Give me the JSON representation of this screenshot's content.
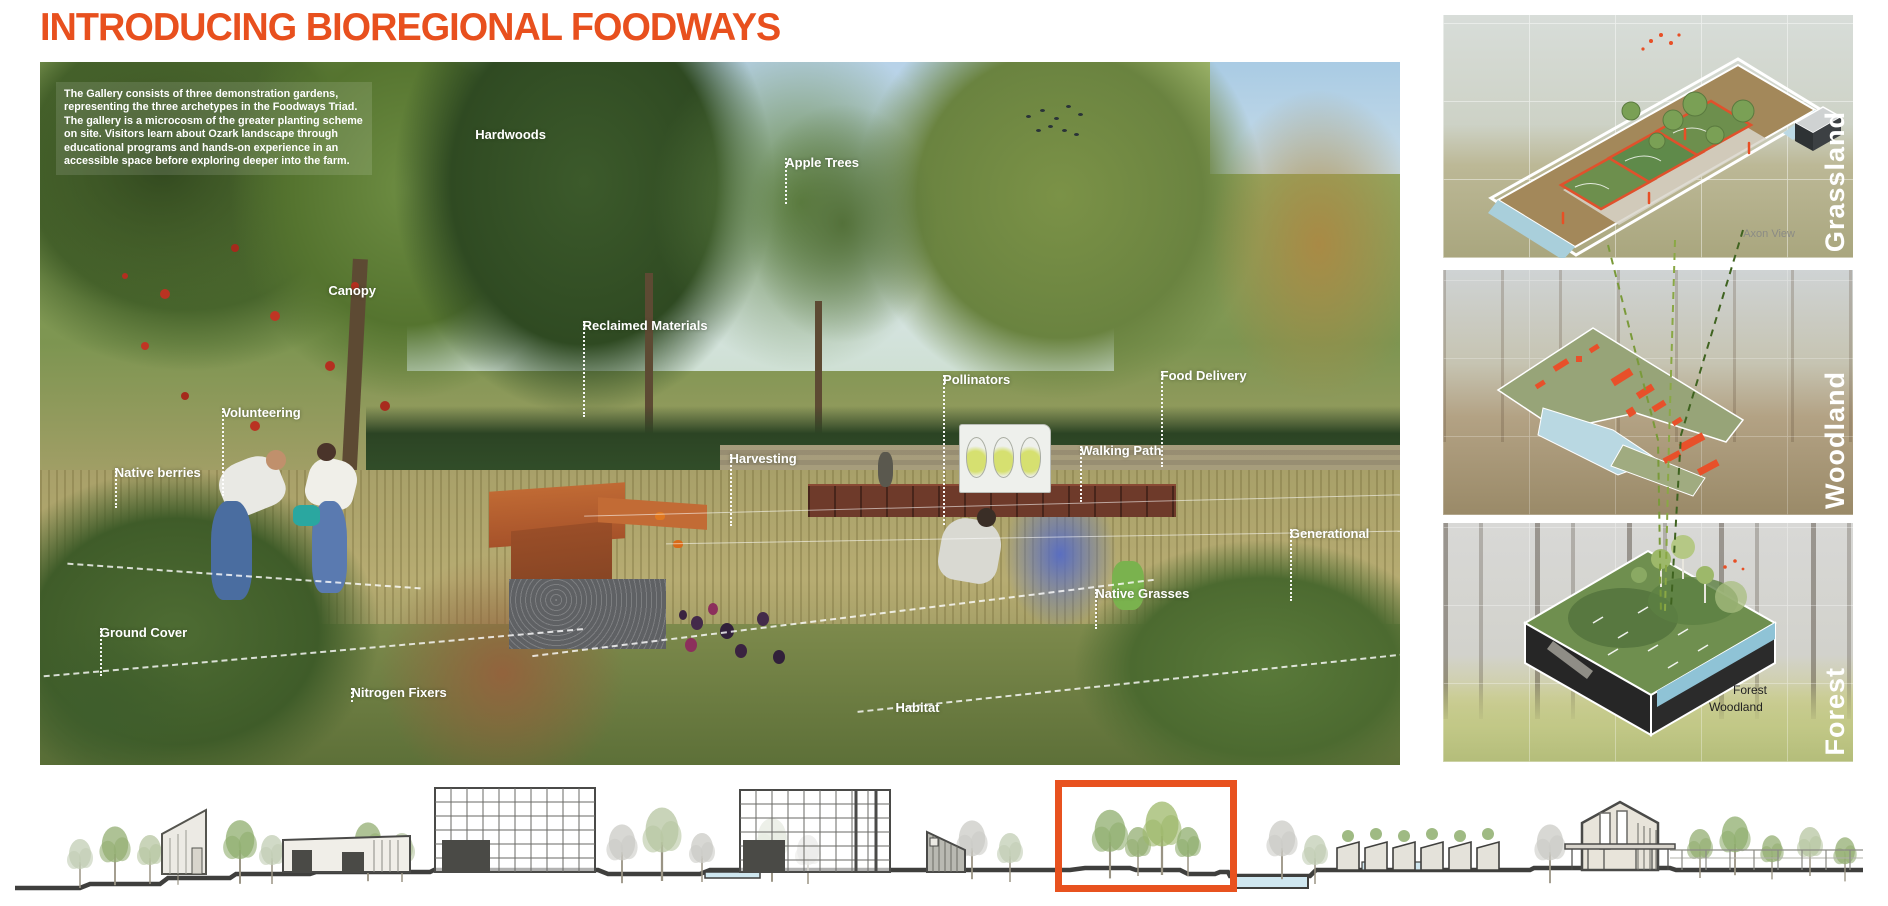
{
  "title": "INTRODUCING BIOREGIONAL FOODWAYS",
  "description": "The Gallery consists of three demonstration gardens, representing the three archetypes in the Foodways Triad. The gallery is a microcosm of the greater planting scheme on site. Visitors learn about Ozark landscape through educational programs and hands-on experience in an accessible space before exploring deeper into the farm.",
  "colors": {
    "accent_orange": "#E8501E",
    "highlight_box_orange": "#E8521F",
    "label_white": "#FFFFFF",
    "corten_rust": "#A6522A",
    "plan_olive": "#97A478",
    "water_blue": "#B9D8E2"
  },
  "main_render": {
    "labels": [
      {
        "text": "Hardwoods",
        "x": 32.0,
        "y": 9.2,
        "leader": 0
      },
      {
        "text": "Apple Trees",
        "x": 54.8,
        "y": 13.3,
        "leader": 46
      },
      {
        "text": "Canopy",
        "x": 21.2,
        "y": 31.5,
        "leader": 0
      },
      {
        "text": "Reclaimed Materials",
        "x": 39.9,
        "y": 36.4,
        "leader": 96
      },
      {
        "text": "Pollinators",
        "x": 66.4,
        "y": 44.1,
        "leader": 150
      },
      {
        "text": "Food Delivery",
        "x": 82.4,
        "y": 43.5,
        "leader": 96
      },
      {
        "text": "Volunteering",
        "x": 13.4,
        "y": 48.8,
        "leader": 88
      },
      {
        "text": "Harvesting",
        "x": 50.7,
        "y": 55.4,
        "leader": 72
      },
      {
        "text": "Walking Path",
        "x": 76.5,
        "y": 54.2,
        "leader": 56
      },
      {
        "text": "Native berries",
        "x": 5.5,
        "y": 57.3,
        "leader": 40
      },
      {
        "text": "Generational",
        "x": 91.9,
        "y": 66.0,
        "leader": 72
      },
      {
        "text": "Native Grasses",
        "x": 77.6,
        "y": 74.5,
        "leader": 40
      },
      {
        "text": "Ground Cover",
        "x": 4.4,
        "y": 80.1,
        "leader": 48
      },
      {
        "text": "Nitrogen Fixers",
        "x": 22.9,
        "y": 88.6,
        "leader": 14
      },
      {
        "text": "Habitat",
        "x": 62.9,
        "y": 90.8,
        "leader": 0
      }
    ]
  },
  "right_panels": [
    {
      "id": "grassland",
      "vertical_label": "Grassland",
      "caption": "Axon View"
    },
    {
      "id": "woodland",
      "vertical_label": "Woodland"
    },
    {
      "id": "forest",
      "vertical_label": "Forest",
      "axon_labels": [
        "Forest",
        "Woodland"
      ]
    }
  ]
}
